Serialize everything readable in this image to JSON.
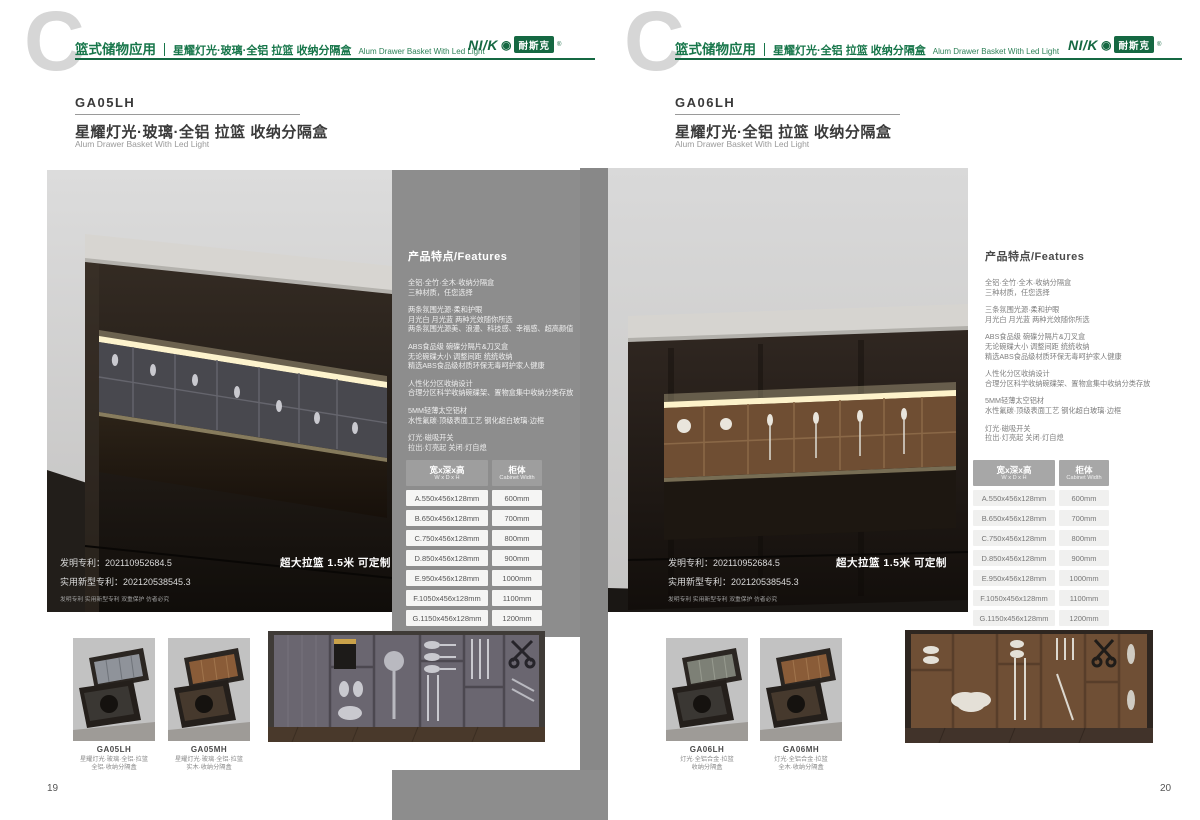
{
  "brand": {
    "logo_latin": "NI/K",
    "logo_ring": "◉",
    "logo_cn": "耐斯克",
    "logo_reg": "®",
    "green": "#156842"
  },
  "colors": {
    "brand_green": "#17764a",
    "panel_gray": "#8d8d8d",
    "table_header_gray": "#9e9e9e",
    "led_warm": "#f5e7bb"
  },
  "pages": [
    {
      "page_number": "19",
      "header": {
        "category": "篮式储物应用",
        "title_cn": "星耀灯光·玻璃·全铝 拉篮 收纳分隔盒",
        "title_en": "Alum Drawer Basket With Led Light"
      },
      "product": {
        "code": "GA05LH",
        "name_cn": "星耀灯光·玻璃·全铝 拉篮 收纳分隔盒",
        "name_en": "Alum Drawer Basket With Led Light"
      },
      "photo": {
        "patent_line1": "发明专利：202110952684.5",
        "patent_line2": "实用新型专利：202120538545.3",
        "patent_line3": "发明专利 实用新型专利 双重保护 仿者必究",
        "banner": "超大拉篮 1.5米 可定制"
      },
      "features": {
        "heading": "产品特点/Features",
        "groups": [
          [
            "全铝·全竹·全木·收纳分隔盒",
            "三种材质，任您选择"
          ],
          [
            "两条氛围光源·柔和护眼",
            "月光白 月光蓝 两种光效随你所选",
            "两条氛围光源美、浪漫、科技感、幸福感、超高颜值"
          ],
          [
            "ABS食品级 碗碟分隔片&刀叉盒",
            "无论碗碟大小 调整间距 统统收纳",
            "精选ABS食品级材质环保无毒呵护家人健康"
          ],
          [
            "人性化分区收纳设计",
            "合理分区科学收纳碗碟架、置物盒集中收纳分类存放"
          ],
          [
            "5MM轻薄太空铝材",
            "水性氟碳·顶级表面工艺 钢化超白玻璃·边框"
          ],
          [
            "灯光·磁吸开关",
            "拉出·灯亮起 关闭·灯自熄"
          ]
        ]
      },
      "size_table": {
        "col1_cn": "宽x深x高",
        "col1_en": "W x D x H",
        "col2_cn": "柜体",
        "col2_en": "Cabinet Width",
        "rows": [
          [
            "A.550x456x128mm",
            "600mm"
          ],
          [
            "B.650x456x128mm",
            "700mm"
          ],
          [
            "C.750x456x128mm",
            "800mm"
          ],
          [
            "D.850x456x128mm",
            "900mm"
          ],
          [
            "E.950x456x128mm",
            "1000mm"
          ],
          [
            "F.1050x456x128mm",
            "1100mm"
          ],
          [
            "G.1150x456x128mm",
            "1200mm"
          ]
        ]
      },
      "thumbnails": [
        {
          "code": "GA05LH",
          "line1": "星耀灯光·玻璃·全铝·拉篮",
          "line2": "全铝·收纳分隔盒"
        },
        {
          "code": "GA05MH",
          "line1": "星耀灯光·玻璃·全铝·拉篮",
          "line2": "实木·收纳分隔盒"
        }
      ]
    },
    {
      "page_number": "20",
      "header": {
        "category": "篮式储物应用",
        "title_cn": "星耀灯光·全铝 拉篮 收纳分隔盒",
        "title_en": "Alum Drawer Basket With Led Light"
      },
      "product": {
        "code": "GA06LH",
        "name_cn": "星耀灯光·全铝 拉篮 收纳分隔盒",
        "name_en": "Alum Drawer Basket With Led Light"
      },
      "photo": {
        "patent_line1": "发明专利：202110952684.5",
        "patent_line2": "实用新型专利：202120538545.3",
        "patent_line3": "发明专利 实用新型专利 双重保护 仿者必究",
        "banner": "超大拉篮 1.5米 可定制"
      },
      "features": {
        "heading": "产品特点/Features",
        "groups": [
          [
            "全铝·全竹·全木·收纳分隔盒",
            "三种材质，任您选择"
          ],
          [
            "三条氛围光源·柔和护眼",
            "月光白 月光蓝 两种光效随你所选"
          ],
          [
            "ABS食品级 碗碟分隔片&刀叉盒",
            "无论碗碟大小 调整间距 统统收纳",
            "精选ABS食品级材质环保无毒呵护家人健康"
          ],
          [
            "人性化分区收纳设计",
            "合理分区科学收纳碗碟架、置物盒集中收纳分类存放"
          ],
          [
            "5MM轻薄太空铝材",
            "水性氟碳·顶级表面工艺 钢化超白玻璃·边框"
          ],
          [
            "灯光·磁吸开关",
            "拉出·灯亮起 关闭·灯自熄"
          ]
        ]
      },
      "size_table": {
        "col1_cn": "宽x深x高",
        "col1_en": "W x D x H",
        "col2_cn": "柜体",
        "col2_en": "Cabinet Width",
        "rows": [
          [
            "A.550x456x128mm",
            "600mm"
          ],
          [
            "B.650x456x128mm",
            "700mm"
          ],
          [
            "C.750x456x128mm",
            "800mm"
          ],
          [
            "D.850x456x128mm",
            "900mm"
          ],
          [
            "E.950x456x128mm",
            "1000mm"
          ],
          [
            "F.1050x456x128mm",
            "1100mm"
          ],
          [
            "G.1150x456x128mm",
            "1200mm"
          ]
        ]
      },
      "thumbnails": [
        {
          "code": "GA06LH",
          "line1": "灯光·全铝合金·拉篮",
          "line2": "收纳分隔盒"
        },
        {
          "code": "GA06MH",
          "line1": "灯光·全铝合金·拉篮",
          "line2": "全木·收纳分隔盒"
        }
      ]
    }
  ]
}
